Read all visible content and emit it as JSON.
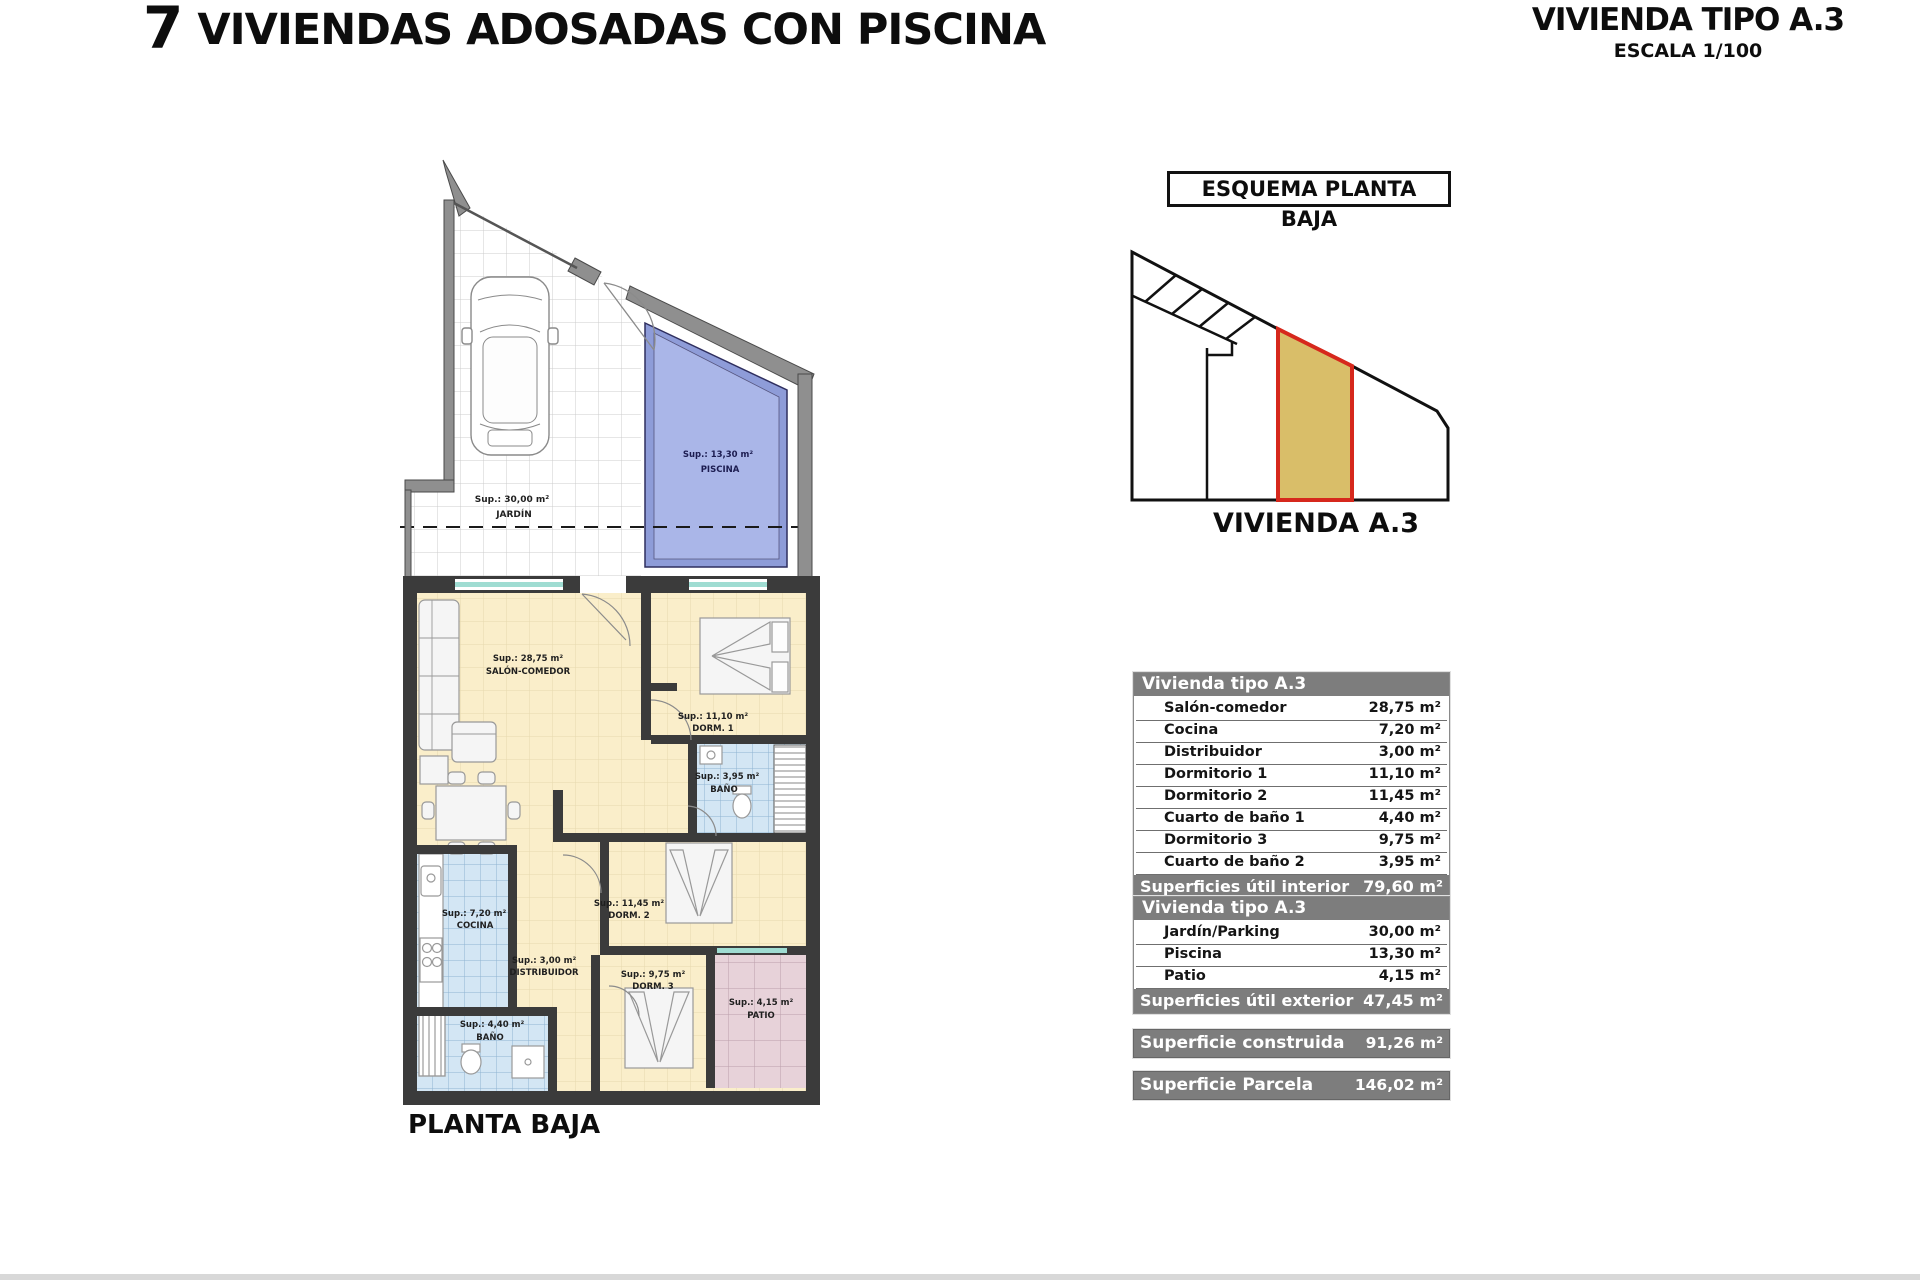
{
  "header": {
    "title_number": "7",
    "title_text": " VIVIENDAS ADOSADAS CON PISCINA",
    "type_title": "VIVIENDA TIPO A.3",
    "scale": "ESCALA 1/100"
  },
  "schema": {
    "label": "ESQUEMA PLANTA BAJA",
    "caption": "VIVIENDA A.3"
  },
  "plan": {
    "caption": "PLANTA BAJA",
    "jardin_sup": "Sup.: 30,00 m²",
    "jardin_name": "JARDÍN",
    "piscina_sup": "Sup.: 13,30 m²",
    "piscina_name": "PISCINA",
    "salon_sup": "Sup.: 28,75 m²",
    "salon_name": "SALÓN-COMEDOR",
    "dorm1_sup": "Sup.: 11,10 m²",
    "dorm1_name": "DORM. 1",
    "bano1_sup": "Sup.: 3,95 m²",
    "bano1_name": "BAÑO",
    "cocina_sup": "Sup.: 7,20 m²",
    "cocina_name": "COCINA",
    "distribuidor_sup": "Sup.: 3,00 m²",
    "distribuidor_name": "DISTRIBUIDOR",
    "dorm2_sup": "Sup.: 11,45 m²",
    "dorm2_name": "DORM. 2",
    "dorm3_sup": "Sup.: 9,75 m²",
    "dorm3_name": "DORM. 3",
    "bano2_sup": "Sup.: 4,40 m²",
    "bano2_name": "BAÑO",
    "patio_sup": "Sup.: 4,15 m²",
    "patio_name": "PATIO"
  },
  "tables": {
    "interior": {
      "header": "Vivienda tipo A.3",
      "rows": [
        [
          "Salón-comedor",
          "28,75 m²"
        ],
        [
          "Cocina",
          "7,20 m²"
        ],
        [
          "Distribuidor",
          "3,00 m²"
        ],
        [
          "Dormitorio 1",
          "11,10 m²"
        ],
        [
          "Dormitorio 2",
          "11,45 m²"
        ],
        [
          "Cuarto de baño 1",
          "4,40 m²"
        ],
        [
          "Dormitorio 3",
          "9,75 m²"
        ],
        [
          "Cuarto de baño 2",
          "3,95 m²"
        ]
      ],
      "footer_label": "Superficies útil interior",
      "footer_value": "79,60 m²"
    },
    "exterior": {
      "header": "Vivienda tipo A.3",
      "rows": [
        [
          "Jardín/Parking",
          "30,00 m²"
        ],
        [
          "Piscina",
          "13,30 m²"
        ],
        [
          "Patio",
          "4,15 m²"
        ]
      ],
      "footer_label": "Superficies útil exterior",
      "footer_value": "47,45 m²"
    },
    "construida": {
      "label": "Superficie construida",
      "value": "91,26 m²"
    },
    "parcela": {
      "label": "Superficie Parcela",
      "value": "146,02 m²"
    }
  },
  "colors": {
    "highlight_fill": "#d9be69",
    "highlight_border": "#d6281c",
    "table_gray": "#7d7d7d",
    "pool_blue": "#aab6e8",
    "bath_blue": "#d3e6f4",
    "patio_pink": "#e7d2d9",
    "floor_cream": "#faeeca"
  }
}
